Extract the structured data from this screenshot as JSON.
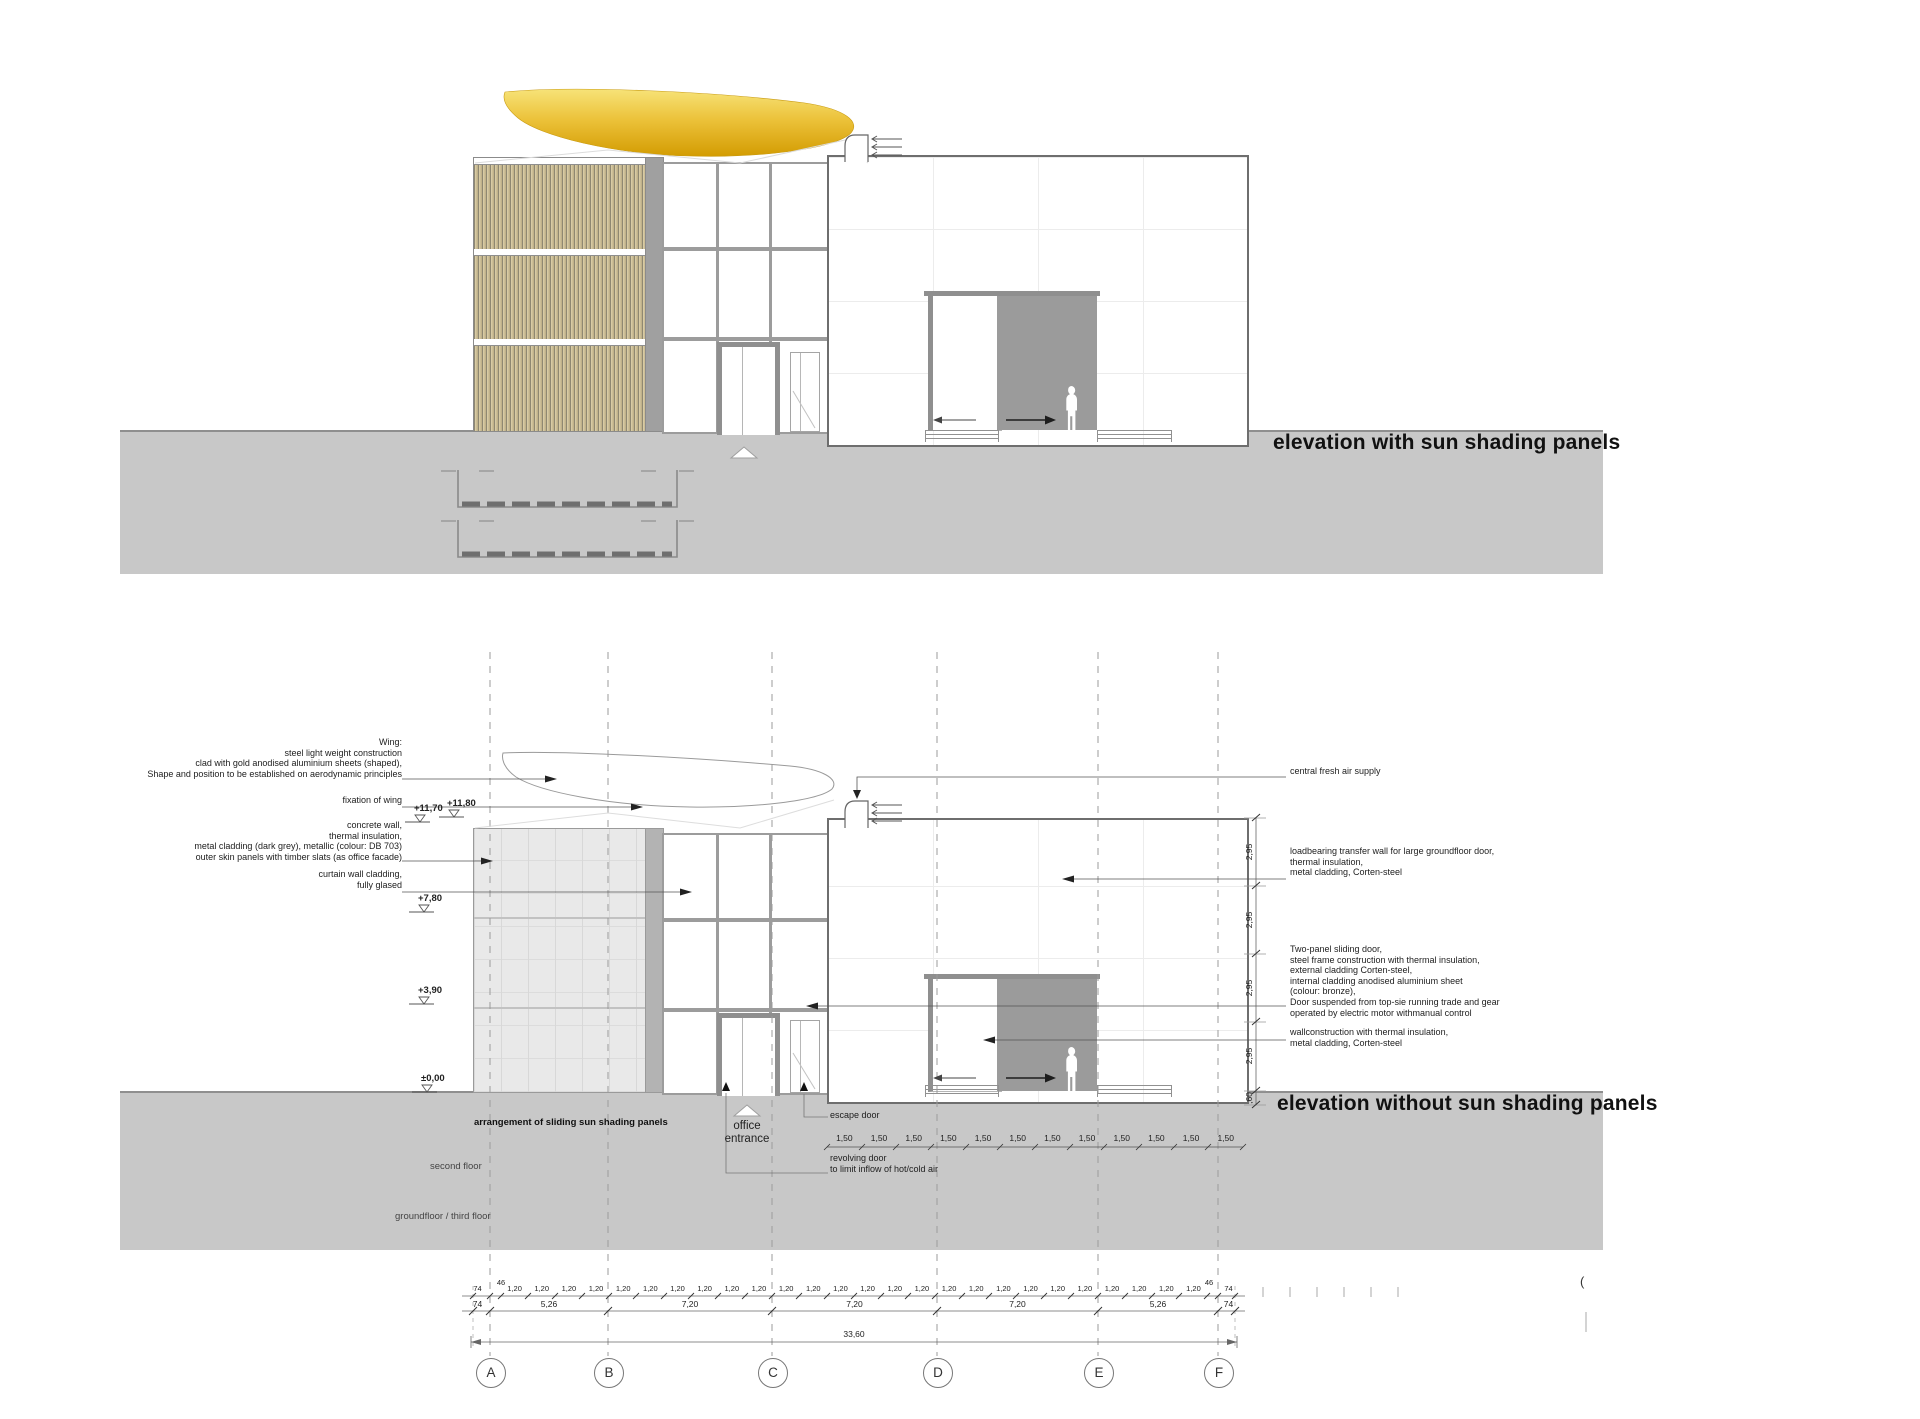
{
  "titles": {
    "top": "elevation with sun shading panels",
    "bottom": "elevation without sun shading panels"
  },
  "annotations_left": {
    "wing": [
      "Wing:",
      "steel light weight construction",
      "clad with gold anodised aluminium sheets (shaped),",
      "Shape and position to be established on aerodynamic principles"
    ],
    "fixation": [
      "fixation of wing"
    ],
    "concrete": [
      "concrete wall,",
      "thermal insulation,",
      "metal cladding (dark grey), metallic (colour: DB 703)",
      "outer skin panels with timber slats (as office facade)"
    ],
    "curtain": [
      "curtain wall cladding,",
      "fully glased"
    ]
  },
  "annotations_right": {
    "air": [
      "central fresh air supply"
    ],
    "loadbearing": [
      "loadbearing transfer wall for large groundfloor door,",
      "thermal insulation,",
      "metal cladding, Corten-steel"
    ],
    "sliding_door": [
      "Two-panel sliding door,",
      "steel frame construction with thermal insulation,",
      "external cladding Corten-steel,",
      "internal cladding anodised aluminium sheet",
      "(colour: bronze),",
      "Door suspended from top-sie running trade and gear",
      "operated by electric motor withmanual control"
    ],
    "wall": [
      "wallconstruction with thermal insulation,",
      "metal cladding, Corten-steel"
    ]
  },
  "levels": [
    "+11,70",
    "+11,80",
    "+7,80",
    "+3,90",
    "±0,00"
  ],
  "floor_labels": {
    "arrangement": "arrangement of sliding sun shading panels",
    "second": "second floor",
    "ground": "groundfloor / third floor"
  },
  "entrance": {
    "office": "office entrance",
    "escape": "escape door",
    "revolving": [
      "revolving door",
      "to limit inflow of hot/cold air"
    ]
  },
  "dimensions": {
    "row_150": [
      "1,50",
      "1,50",
      "1,50",
      "1,50",
      "1,50",
      "1,50",
      "1,50",
      "1,50",
      "1,50",
      "1,50",
      "1,50",
      "1,50"
    ],
    "row1_left": [
      "74",
      "46"
    ],
    "row1_mid": [
      "1,20",
      "1,20",
      "1,20",
      "1,20",
      "1,20",
      "1,20",
      "1,20",
      "1,20",
      "1,20",
      "1,20",
      "1,20",
      "1,20",
      "1,20",
      "1,20",
      "1,20",
      "1,20",
      "1,20",
      "1,20",
      "1,20",
      "1,20",
      "1,20",
      "1,20",
      "1,20",
      "1,20",
      "1,20",
      "1,20"
    ],
    "row1_right": [
      "46",
      "74"
    ],
    "row2": [
      "74",
      "5,26",
      "7,20",
      "7,20",
      "7,20",
      "5,26",
      "74"
    ],
    "total": "33,60",
    "vertical": [
      "2,95",
      "2,95",
      "2,95",
      "2,95"
    ],
    "vertical_base": ",60"
  },
  "grid_bubbles": [
    "A",
    "B",
    "C",
    "D",
    "E",
    "F"
  ],
  "fragment": "(",
  "colors": {
    "gold": "#e2b428",
    "ground_grey": "#c8c8c8",
    "door_opening_grey": "#9b9b9b"
  }
}
